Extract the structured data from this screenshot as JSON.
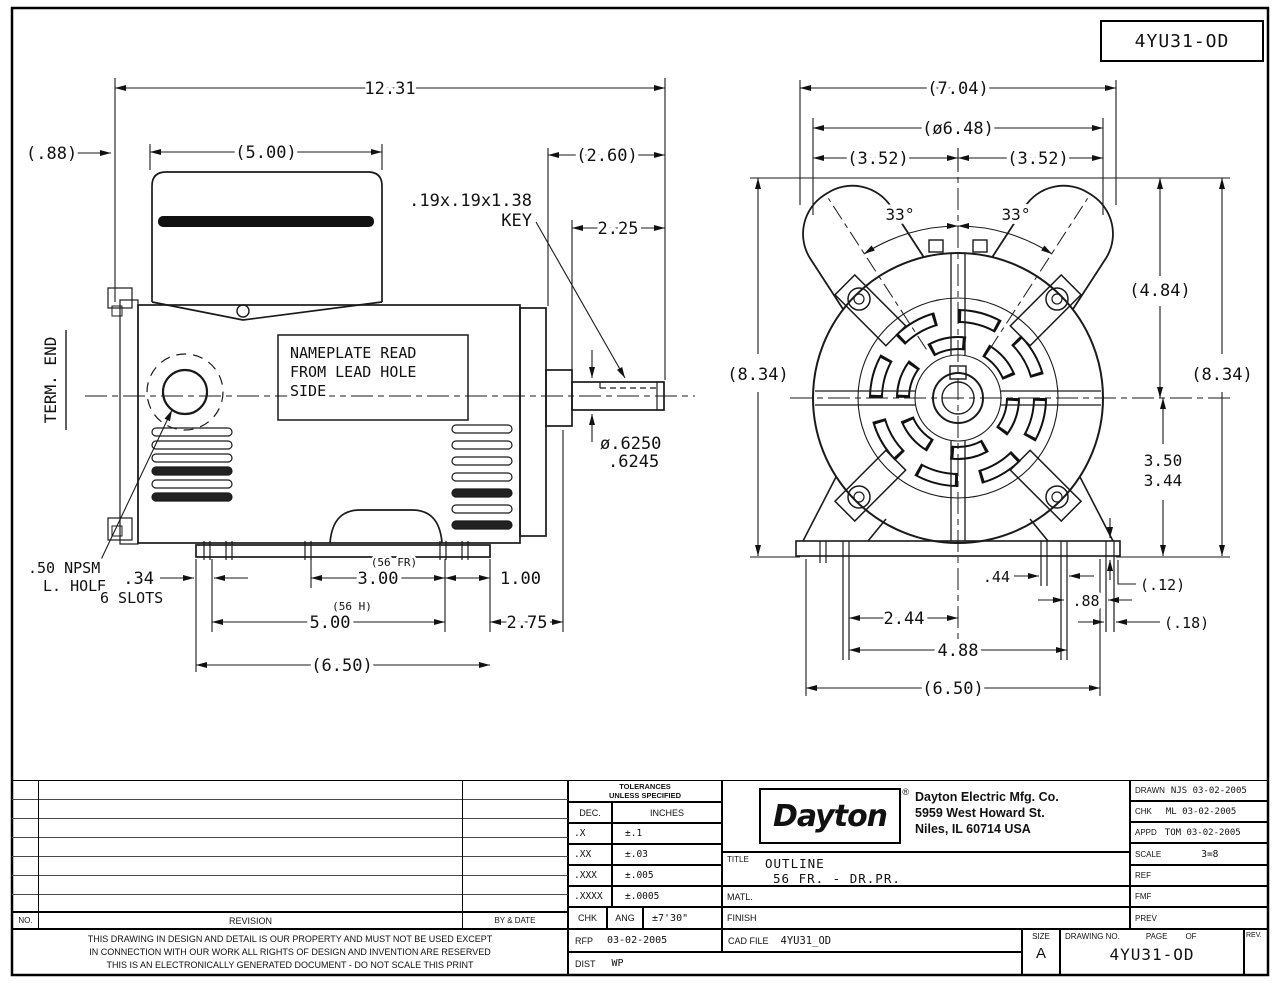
{
  "doc": {
    "drawing_number": "4YU31-OD"
  },
  "side_view": {
    "term_end_label": "TERM. END",
    "nameplate_note_line1": "NAMEPLATE READ",
    "nameplate_note_line2": "FROM LEAD HOLE",
    "nameplate_note_line3": "SIDE",
    "dim_overall_length": "12.31",
    "dim_rear_overhang": "(.88)",
    "dim_conduit_box_width": "(5.00)",
    "dim_shaft_extension": "(2.60)",
    "key_note": ".19x.19x1.38",
    "key_note_label": "KEY",
    "dim_shaft_length": "2.25",
    "dim_shaft_dia_max": "ø.6250",
    "dim_shaft_dia_min": ".6245",
    "lead_hole_note_line1": ".50 NPSM",
    "lead_hole_note_line2": "L. HOLE",
    "dim_slot_width": ".34",
    "slots_note": "6 SLOTS",
    "dim_foot_spacing": "3.00",
    "foot_spacing_note": "(56 FR)",
    "dim_foot_to_base_end": "1.00",
    "dim_mounting_length": "5.00",
    "mounting_note": "(56 H)",
    "dim_base_to_shaft_face": "2.75",
    "dim_base_length": "(6.50)"
  },
  "end_view": {
    "dim_overall_width": "(7.04)",
    "dim_guard_diameter": "(ø6.48)",
    "dim_half_width_left": "(3.52)",
    "dim_half_width_right": "(3.52)",
    "angle_left": "33°",
    "angle_right": "33°",
    "dim_overall_height_left": "(8.34)",
    "dim_overall_height_right": "(8.34)",
    "dim_top_to_centerline": "(4.84)",
    "dim_shaft_height_max": "3.50",
    "dim_shaft_height_min": "3.44",
    "dim_foot_slot_offset": ".44",
    "dim_foot_slot_spacing": ".88",
    "dim_base_step_height": "(.12)",
    "dim_base_step_width": "(.18)",
    "dim_centerline_to_foot": "2.44",
    "dim_foot_spread": "4.88",
    "dim_base_width": "(6.50)"
  },
  "title_block": {
    "tolerances": {
      "header_line1": "TOLERANCES",
      "header_line2": "UNLESS SPECIFIED",
      "col_dec": "DEC.",
      "col_inches": "INCHES",
      "rows": [
        {
          "dec": ".X",
          "inches": "±.1"
        },
        {
          "dec": ".XX",
          "inches": "±.03"
        },
        {
          "dec": ".XXX",
          "inches": "±.005"
        },
        {
          "dec": ".XXXX",
          "inches": "±.0005"
        }
      ],
      "chk_label": "CHK",
      "ang_label": "ANG",
      "ang_value": "±7'30\""
    },
    "company": {
      "logo": "Dayton",
      "logo_mark": "®",
      "name": "Dayton Electric Mfg. Co.",
      "address_line1": "5959 West Howard St.",
      "address_line2": "Niles, IL 60714  USA"
    },
    "title_label": "TITLE",
    "title_line1": "OUTLINE",
    "title_line2": "56 FR. - DR.PR.",
    "matl_label": "MATL.",
    "finish_label": "FINISH",
    "approvals": [
      {
        "label": "DRAWN",
        "value": "NJS 03-02-2005"
      },
      {
        "label": "CHK",
        "value": "ML  03-02-2005"
      },
      {
        "label": "APPD",
        "value": "TOM 03-02-2005"
      },
      {
        "label": "SCALE",
        "value": "3=8"
      },
      {
        "label": "REF",
        "value": ""
      },
      {
        "label": "FMF",
        "value": ""
      },
      {
        "label": "PREV",
        "value": ""
      }
    ],
    "revision": {
      "no_label": "NO.",
      "revision_label": "REVISION",
      "by_date_label": "BY & DATE"
    },
    "disclaimer_line1": "THIS DRAWING IN DESIGN AND DETAIL IS OUR PROPERTY AND MUST NOT BE USED EXCEPT",
    "disclaimer_line2": "IN CONNECTION WITH OUR WORK ALL RIGHTS OF DESIGN AND INVENTION ARE RESERVED",
    "disclaimer_line3": "THIS IS AN ELECTRONICALLY GENERATED DOCUMENT - DO NOT SCALE THIS PRINT",
    "rfp_label": "RFP",
    "rfp_date": "03-02-2005",
    "cad_file_label": "CAD FILE",
    "cad_file_value": "4YU31_OD",
    "dist_label": "DIST",
    "dist_value": "WP",
    "size_label": "SIZE",
    "size_value": "A",
    "drawing_no_label": "DRAWING NO.",
    "page_label": "PAGE",
    "of_label": "OF",
    "rev_label": "REV.",
    "drawing_number": "4YU31-OD"
  }
}
